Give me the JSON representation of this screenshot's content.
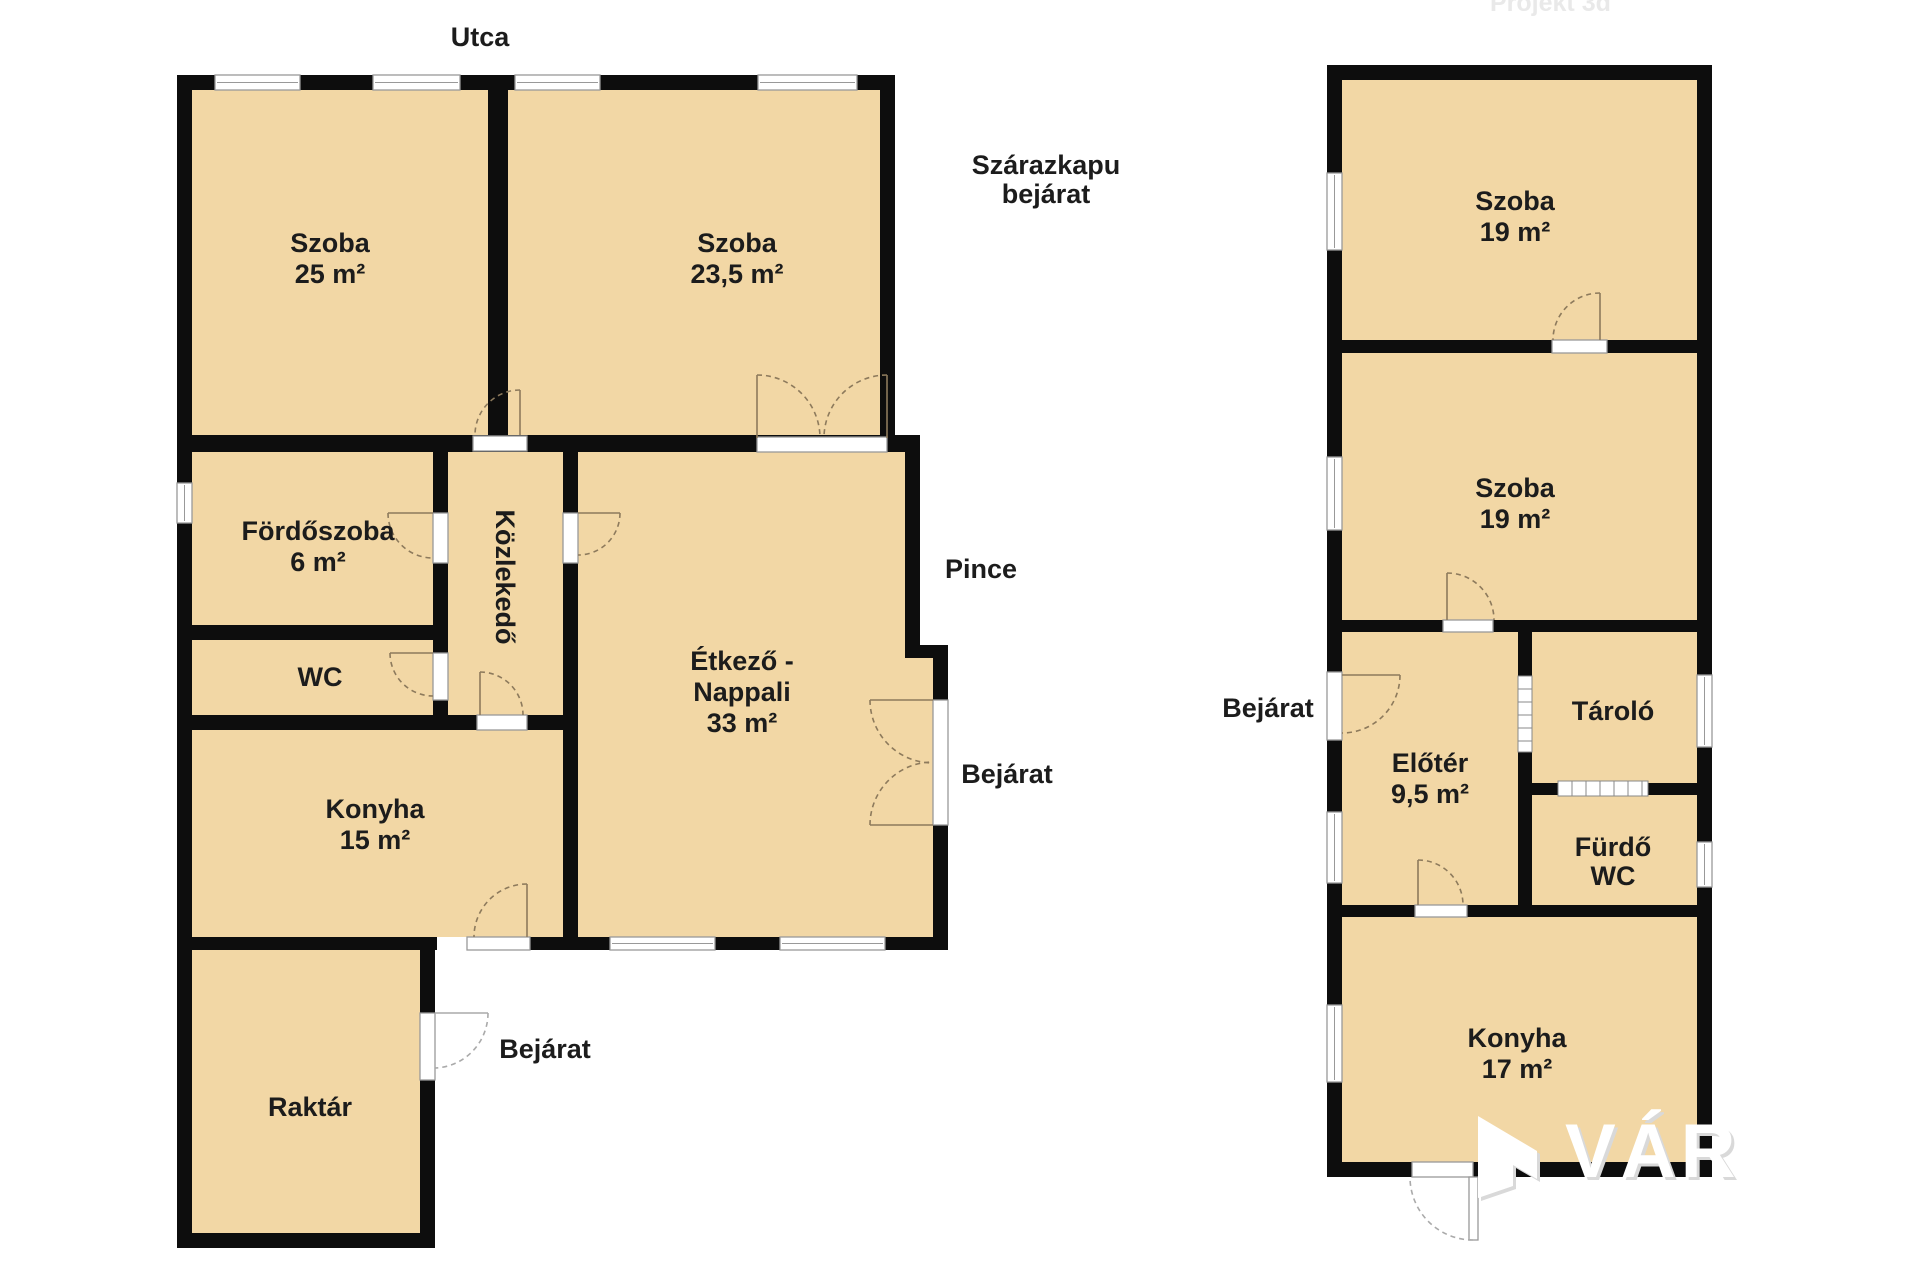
{
  "colors": {
    "floor": "#f2d7a5",
    "wall": "#0d0d0d",
    "window_frame": "#999999",
    "door_arc": "#8d7a5c",
    "label_text": "#1c1c1c",
    "watermark_faint": "#e9e9e9",
    "watermark_brand": "#ffffff"
  },
  "left": {
    "szoba1": {
      "name": "Szoba",
      "area": "25 m²"
    },
    "szoba2": {
      "name": "Szoba",
      "area": "23,5 m²"
    },
    "fordoszoba": {
      "name": "Fördőszoba",
      "area": "6 m²"
    },
    "kozlekedo": {
      "name": "Közlekedő"
    },
    "wc": {
      "name": "WC"
    },
    "konyha": {
      "name": "Konyha",
      "area": "15 m²"
    },
    "etkezo": {
      "line1": "Étkező -",
      "line2": "Nappali",
      "area": "33 m²"
    },
    "raktar": {
      "name": "Raktár"
    },
    "labels": {
      "utca": "Utca",
      "szarazkapu_line1": "Szárazkapu",
      "szarazkapu_line2": "bejárat",
      "pince": "Pince",
      "bejarat_etkezo": "Bejárat",
      "bejarat_raktar": "Bejárat"
    }
  },
  "right": {
    "szoba1": {
      "name": "Szoba",
      "area": "19 m²"
    },
    "szoba2": {
      "name": "Szoba",
      "area": "19 m²"
    },
    "eloter": {
      "name": "Előtér",
      "area": "9,5 m²"
    },
    "tarolo": {
      "name": "Tároló"
    },
    "furdo": {
      "line1": "Fürdő",
      "line2": "WC"
    },
    "konyha": {
      "name": "Konyha",
      "area": "17 m²"
    },
    "labels": {
      "bejarat": "Bejárat"
    }
  },
  "watermarks": {
    "top_right": "Projekt 3d",
    "brand": "VÁR"
  }
}
